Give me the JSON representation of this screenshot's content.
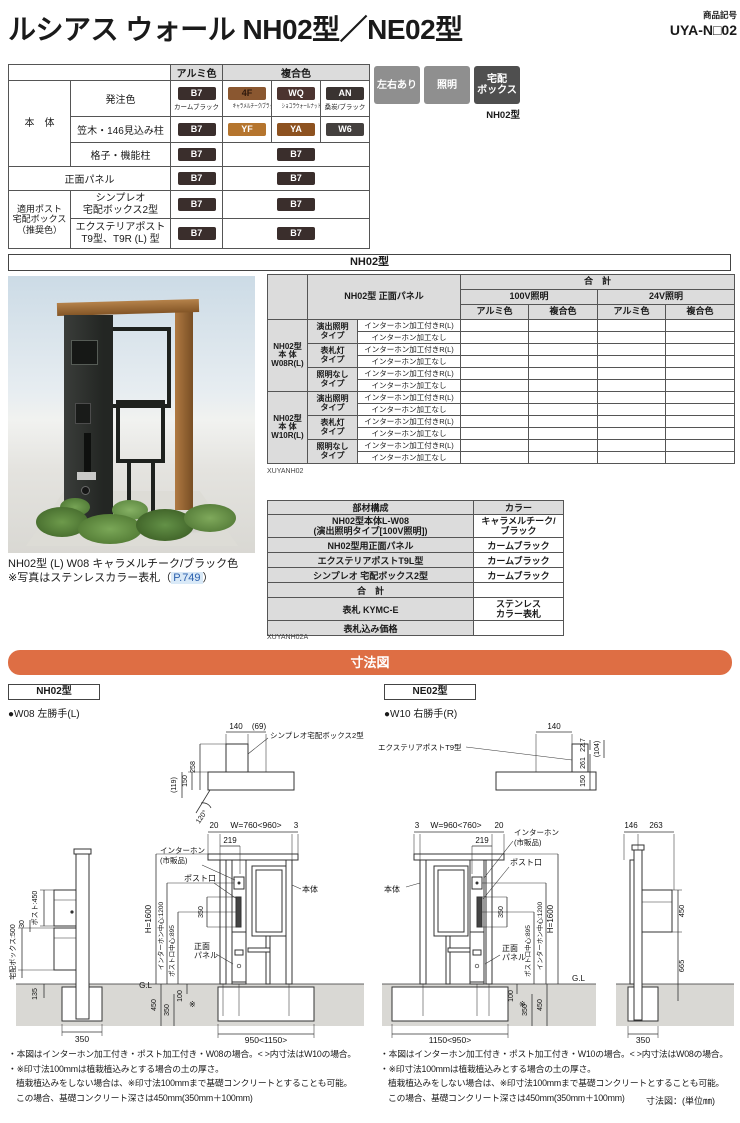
{
  "header": {
    "title": "ルシアス ウォール NH02型／NE02型",
    "code_label": "商品記号",
    "code": "UYA-N□02"
  },
  "colors": {
    "B7": "#3a2e2c",
    "F4": "#8a5730",
    "WQ": "#4c3430",
    "AN": "#3a3331",
    "YF": "#b5752e",
    "YA": "#8d5220",
    "W6": "#44403e",
    "badge_gray": "#8f8f8f",
    "badge_dark": "#4f4f4f",
    "accent_orange": "#de6e44",
    "link_blue": "#2b5fad"
  },
  "color_table": {
    "header": {
      "alumi": "アルミ色",
      "fukugo": "複合色"
    },
    "groups": {
      "body": "本　体",
      "post": "適用ポスト\n宅配ボックス\n（推奨色）"
    },
    "rows": {
      "order": {
        "label": "発注色",
        "alumi_code": "B7",
        "alumi_name": "カームブラック",
        "f1_code": "4F",
        "f1_name": "キャラメルチーク/ブラック",
        "f2_code": "WQ",
        "f2_name": "ショコラウォールナット/ブラック",
        "f3_code": "AN",
        "f3_name": "桑炭/ブラック"
      },
      "kasagi": {
        "label": "笠木・146見込み柱",
        "alumi_code": "B7",
        "f1_code": "YF",
        "f2_code": "YA",
        "f3_code": "W6"
      },
      "koshi": {
        "label": "格子・機能柱",
        "alumi_code": "B7",
        "f_code": "B7"
      },
      "panel": {
        "label": "正面パネル",
        "alumi_code": "B7",
        "f_code": "B7"
      },
      "simpleo": {
        "label": "シンプレオ\n宅配ボックス2型",
        "alumi_code": "B7",
        "f_code": "B7"
      },
      "exterior": {
        "label": "エクステリアポスト\nT9型、T9R (L) 型",
        "alumi_code": "B7",
        "f_code": "B7"
      }
    }
  },
  "badges": {
    "b1": "左右あり",
    "b2": "照明",
    "b3": "宅配\nボックス",
    "model": "NH02型"
  },
  "section_nh02": "NH02型",
  "photo": {
    "caption1": "NH02型 (L) W08 キャラメルチーク/ブラック色",
    "caption2_pre": "※写真はステンレスカラー表札（",
    "caption2_link": "P.749",
    "caption2_post": "）"
  },
  "price_table": {
    "title": "NH02型 正面パネル",
    "total": "合　計",
    "v100": "100V照明",
    "v24": "24V照明",
    "alumi": "アルミ色",
    "fukugo": "複合色",
    "g1": "NH02型\n本 体\nW08R(L)",
    "g2": "NH02型\n本 体\nW10R(L)",
    "t1": "演出照明\nタイプ",
    "t2": "表札灯\nタイプ",
    "t3": "照明なし\nタイプ",
    "s1": "インターホン加工付きR(L)",
    "s2": "インターホン加工なし",
    "code": "XUYANH02"
  },
  "parts_table": {
    "h1": "部材構成",
    "h2": "カラー",
    "r1": "NH02型本体L-W08\n(演出照明タイプ[100V照明])",
    "c1": "キャラメルチーク/\nブラック",
    "r2": "NH02型用正面パネル",
    "c2": "カームブラック",
    "r3": "エクステリアポストT9L型",
    "c3": "カームブラック",
    "r4": "シンプレオ 宅配ボックス2型",
    "c4": "カームブラック",
    "r5": "合　計",
    "c5": "",
    "r6": "表札 KYMC-E",
    "c6": "ステンレス\nカラー表札",
    "r7": "表札込み価格",
    "c7": "",
    "code": "XUYANH02A"
  },
  "sunpozu": {
    "bar": "寸法図",
    "left_model": "NH02型",
    "right_model": "NE02型",
    "left_sub": "●W08 左勝手(L)",
    "right_sub": "●W10 右勝手(R)",
    "unit": "寸法図：(単位㎜)"
  },
  "dims_left": {
    "box": "シンプレオ宅配ボックス2型",
    "d140": "140",
    "d69": "(69)",
    "d258": "258",
    "d150": "150",
    "d119": "(119)",
    "ang": "120°",
    "d20": "20",
    "w": "W=760<960>",
    "d3": "3",
    "d219": "219",
    "inter1": "インターホン",
    "inter2": "(市販品)",
    "post_slot": "ポスト口",
    "body": "本体",
    "d350": "350",
    "panel1": "正面",
    "panel2": "パネル",
    "h": "H=1600",
    "ic": "インターホン中心:1200",
    "pc": "ポスト口中心:895",
    "gl": "G.L",
    "d450": "450",
    "d350b": "350",
    "d100": "100",
    "kome": "※",
    "wbase": "950<1150>",
    "side_post": "ポスト:450",
    "d30": "30",
    "side_box": "宅配ボックス:500",
    "d135": "135",
    "d350s": "350"
  },
  "dims_right": {
    "box": "エクステリアポストT9型",
    "d140": "140",
    "d227": "22.7",
    "d104": "(104)",
    "d261": "261",
    "d150": "150",
    "d3": "3",
    "w": "W=960<760>",
    "d20": "20",
    "d219": "219",
    "inter1": "インターホン",
    "inter2": "(市販品)",
    "post_slot": "ポスト口",
    "body": "本体",
    "d350": "350",
    "panel1": "正面",
    "panel2": "パネル",
    "h": "H=1600",
    "ic": "インターホン中心:1200",
    "pc": "ポスト口中心:895",
    "gl": "G.L",
    "d100": "100",
    "kome": "※",
    "d350b": "350",
    "d450": "450",
    "wbase": "1150<950>",
    "s146": "146",
    "s263": "263",
    "s450": "450",
    "s665": "665",
    "s350": "350"
  },
  "notes_left": {
    "l1": "・本図はインターホン加工付き・ポスト加工付き・W08の場合。< >内寸法はW10の場合。",
    "l2": "・※印寸法100mmは植栽植込みとする場合の土の厚さ。",
    "l3": "植栽植込みをしない場合は、※印寸法100mmまで基礎コンクリートとすることも可能。",
    "l4": "この場合、基礎コンクリート深さは450mm(350mm＋100mm)"
  },
  "notes_right": {
    "l1": "・本図はインターホン加工付き・ポスト加工付き・W10の場合。< >内寸法はW08の場合。",
    "l2": "・※印寸法100mmは植栽植込みとする場合の土の厚さ。",
    "l3": "植栽植込みをしない場合は、※印寸法100mmまで基礎コンクリートとすることも可能。",
    "l4": "この場合、基礎コンクリート深さは450mm(350mm＋100mm)"
  }
}
